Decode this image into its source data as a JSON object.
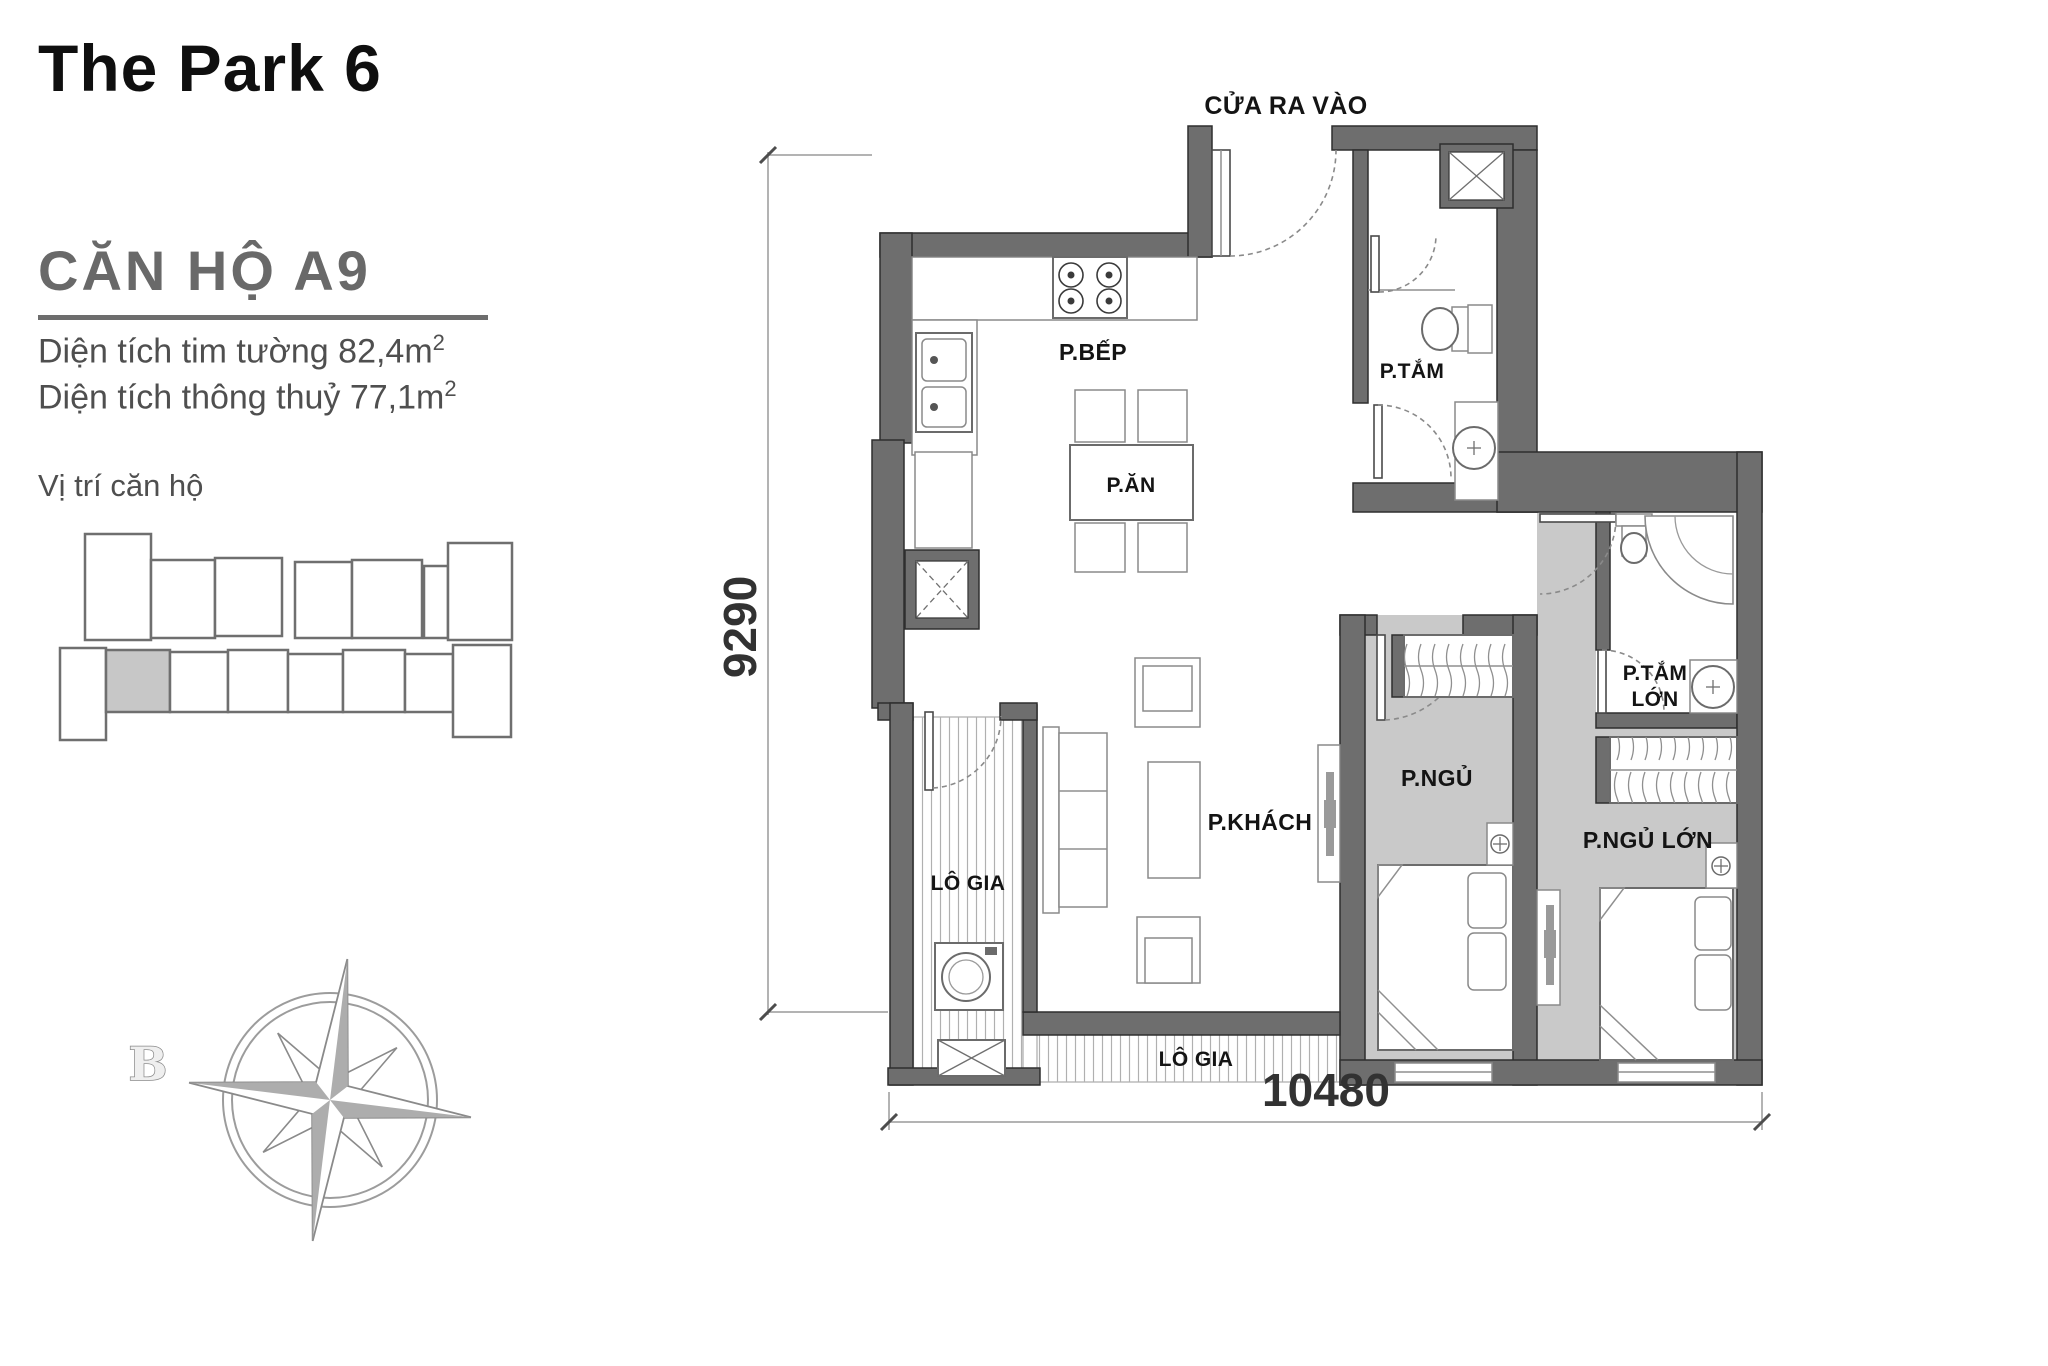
{
  "sidebar": {
    "title": "The Park 6",
    "unit": "CĂN HỘ A9",
    "areas": [
      {
        "text": "Diện tích tim tường 82,4m",
        "sup": "2"
      },
      {
        "text": "Diện tích thông thuỷ 77,1m",
        "sup": "2"
      }
    ],
    "location_label": "Vị trí căn hộ"
  },
  "floor_plan": {
    "entrance": "CỬA RA VÀO",
    "rooms": {
      "kitchen": "P.BẾP",
      "dining": "P.ĂN",
      "bathroom": "P.TẮM",
      "living": "P.KHÁCH",
      "bedroom": "P.NGỦ",
      "master_bathroom_line1": "P.TẮM",
      "master_bathroom_line2": "LỚN",
      "master_bedroom": "P.NGỦ LỚN",
      "loggia_left": "LÔ GIA",
      "loggia_bottom": "LÔ GIA"
    },
    "dimensions": {
      "height_mm": "9290",
      "width_mm": "10480"
    },
    "compass_letter": "B"
  },
  "colors": {
    "wall": "#6e6e6e",
    "floor_gray": "#c9c9c9",
    "text_dark": "#141414",
    "text_gray": "#4f4f4f"
  }
}
